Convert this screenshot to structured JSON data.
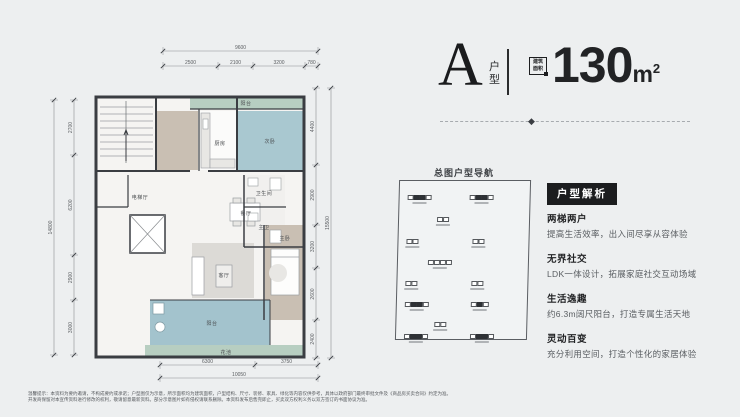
{
  "header": {
    "unit_letter": "A",
    "unit_label_chars": [
      "户",
      "型"
    ],
    "area_badge_line1": "建筑",
    "area_badge_line2": "面积",
    "area_value": "130",
    "area_unit": "m",
    "area_sup": "2"
  },
  "site_nav": {
    "title": "总图户型导航",
    "blocks": [
      {
        "x": 8,
        "y": 14,
        "cells": "wddw"
      },
      {
        "x": 70,
        "y": 14,
        "cells": "wddw"
      },
      {
        "x": 38,
        "y": 36,
        "cells": "ww"
      },
      {
        "x": 8,
        "y": 58,
        "cells": "ww"
      },
      {
        "x": 74,
        "y": 58,
        "cells": "ww"
      },
      {
        "x": 30,
        "y": 79,
        "cells": "wwww"
      },
      {
        "x": 8,
        "y": 100,
        "cells": "ww"
      },
      {
        "x": 74,
        "y": 100,
        "cells": "ww"
      },
      {
        "x": 8,
        "y": 121,
        "cells": "wddw"
      },
      {
        "x": 74,
        "y": 121,
        "cells": "wdw"
      },
      {
        "x": 38,
        "y": 141,
        "cells": "ww"
      },
      {
        "x": 8,
        "y": 153,
        "cells": "wddw"
      },
      {
        "x": 74,
        "y": 153,
        "cells": "wddw"
      }
    ]
  },
  "analysis": {
    "title": "户型解析",
    "items": [
      {
        "heading": "两梯两户",
        "desc": "提高生活效率，出入间尽享从容体验"
      },
      {
        "heading": "无界社交",
        "desc": "LDK一体设计，拓展家庭社交互动场域"
      },
      {
        "heading": "生活逸趣",
        "desc": "约6.3m阔尺阳台，打造专属生活天地"
      },
      {
        "heading": "灵动百变",
        "desc": "充分利用空间，打造个性化的家居体验"
      }
    ]
  },
  "floorplan": {
    "rooms": {
      "balcony_top": "阳台",
      "kitchen": "厨房",
      "bedroom2": "次卧",
      "bath": "卫生间",
      "master_bath": "主卫",
      "dining": "餐厅",
      "living": "客厅",
      "master": "主卧",
      "elevator_hall": "电梯厅",
      "balcony": "阳台",
      "planter": "花池"
    },
    "dims": {
      "top": {
        "total": "9600",
        "segs": [
          "2500",
          "2100",
          "3200",
          "780"
        ]
      },
      "left": {
        "total": "14800",
        "segs": [
          "2700",
          "6200",
          "2900",
          "3000"
        ]
      },
      "right": {
        "total": "15500",
        "segs": [
          "4400",
          "2900",
          "3200",
          "2600",
          "2400"
        ]
      },
      "bottom": {
        "total": "10050",
        "segs": [
          "6300",
          "3750"
        ]
      }
    }
  },
  "disclaimer": {
    "line1": "温馨提示：本资料为要约邀请，不构成要约或承诺；户型图仅为示意，所示面积均为建筑面积，户型结构、尺寸、装修、家具、绿化等内容仅供参考，具体以政府部门最终审批文件及《商品房买卖合同》约定为准。",
    "line2": "开发商保留对本宣传资料进行修改的权利，敬请留意最新资料。部分示意图片如有侵权请联系删除。本资料发布后售完即止，买卖双方权利义务以双方签订的书面协议为准。"
  }
}
